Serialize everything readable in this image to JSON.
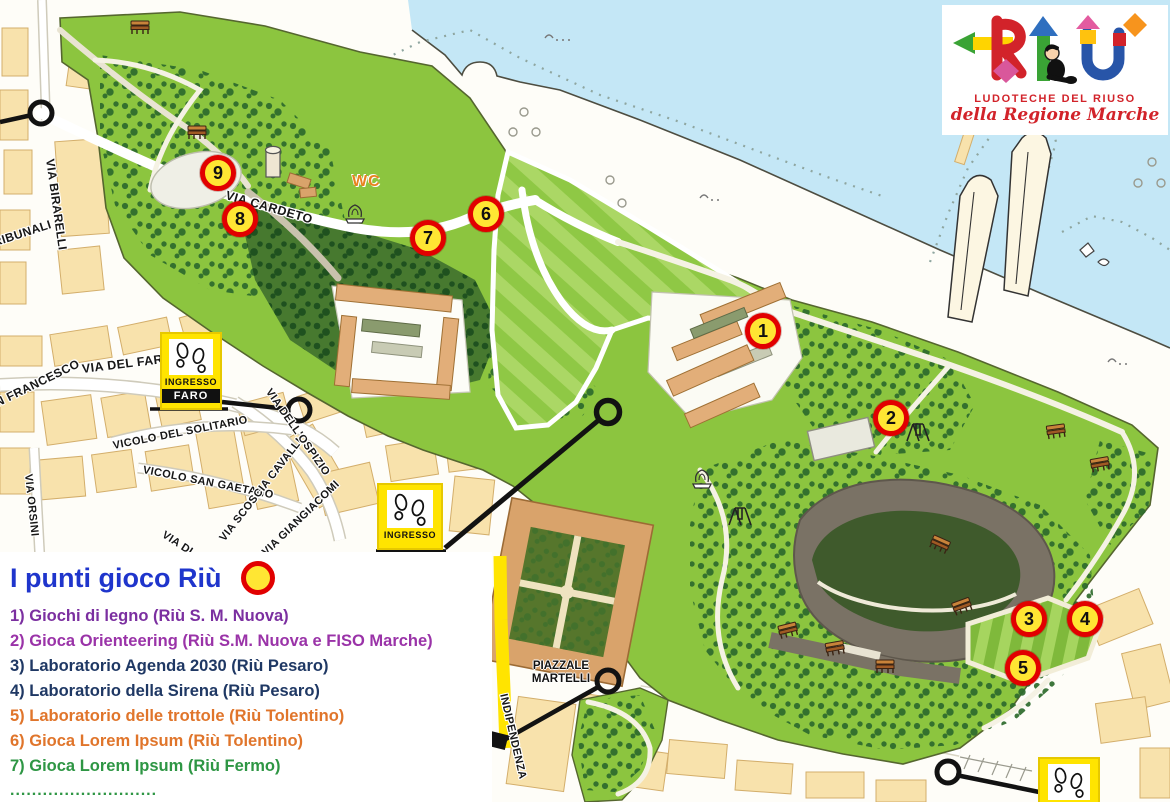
{
  "legend": {
    "title": "I punti gioco Riù",
    "items": [
      {
        "text": "1) Giochi di legno (Riù S. M. Nuova)",
        "color": "#7B2FA0"
      },
      {
        "text": "2) Gioca Orienteering (Riù S.M. Nuova e FISO Marche)",
        "color": "#9A33A8"
      },
      {
        "text": "3) Laboratorio Agenda 2030 (Riù Pesaro)",
        "color": "#1F3864"
      },
      {
        "text": "4) Laboratorio della Sirena (Riù Pesaro)",
        "color": "#1F3864"
      },
      {
        "text": "5) Laboratorio delle trottole (Riù Tolentino)",
        "color": "#E0752B"
      },
      {
        "text": "6) Gioca Lorem Ipsum (Riù Tolentino)",
        "color": "#E0752B"
      },
      {
        "text": "7) Gioca Lorem Ipsum (Riù Fermo)",
        "color": "#2E9644"
      }
    ],
    "ellipsis": "...........................",
    "ellipsis_color": "#2E9644",
    "sample_marker": {
      "fill": "#FFE633",
      "ring": "#E10000"
    }
  },
  "logo": {
    "wordmark": "RIÙ",
    "line1": "LUDOTECHE DEL RIUSO",
    "line2": "della Regione Marche",
    "text_color": "#D2232A",
    "block_colors": [
      "#D2232A",
      "#FFD400",
      "#3AA335",
      "#2F6FBF",
      "#F7941D",
      "#D9579B"
    ]
  },
  "map": {
    "markers": [
      {
        "number": "1"
      },
      {
        "number": "2"
      },
      {
        "number": "3"
      },
      {
        "number": "4"
      },
      {
        "number": "5"
      },
      {
        "number": "6"
      },
      {
        "number": "7"
      },
      {
        "number": "8"
      },
      {
        "number": "9"
      }
    ],
    "streets": [
      {
        "name": "VIA BIRARELLI"
      },
      {
        "name": "TRIBUNALI"
      },
      {
        "name": "VIA CARDETO"
      },
      {
        "name": "VIA DEL FARO"
      },
      {
        "name": "SAN FRANCESCO"
      },
      {
        "name": "VICOLO DEL SOLITARIO"
      },
      {
        "name": "VICOLO SAN GAETANO"
      },
      {
        "name": "VIA ORSINI"
      },
      {
        "name": "VIA  SCOSCIA CAVALLI"
      },
      {
        "name": "VIA GIANGIACOMI"
      },
      {
        "name": "VIA DELL'OSPIZIO"
      },
      {
        "name": "VIA DI"
      },
      {
        "name": "INDIPENDENZA"
      }
    ],
    "labels": {
      "wc": "WC",
      "piazzale": "PIAZZALE\nMARTELLI"
    },
    "signs": {
      "faro_line1": "INGRESSO",
      "faro_line2": "FARO",
      "ingresso": "INGRESSO"
    },
    "colors": {
      "sea": "#C4E7F6",
      "park_green": "#8CC53F",
      "lawn_stripe": "#ABD765",
      "forest_dot": "#2D6A2D",
      "hill_grey": "#7A7265",
      "building_city": "#F8E2AC",
      "building_park": "#E2AE79",
      "marker_fill": "#FFE633",
      "marker_ring": "#E10000",
      "route_yellow": "#FFE400",
      "legend_title_blue": "#1F35CC"
    }
  }
}
